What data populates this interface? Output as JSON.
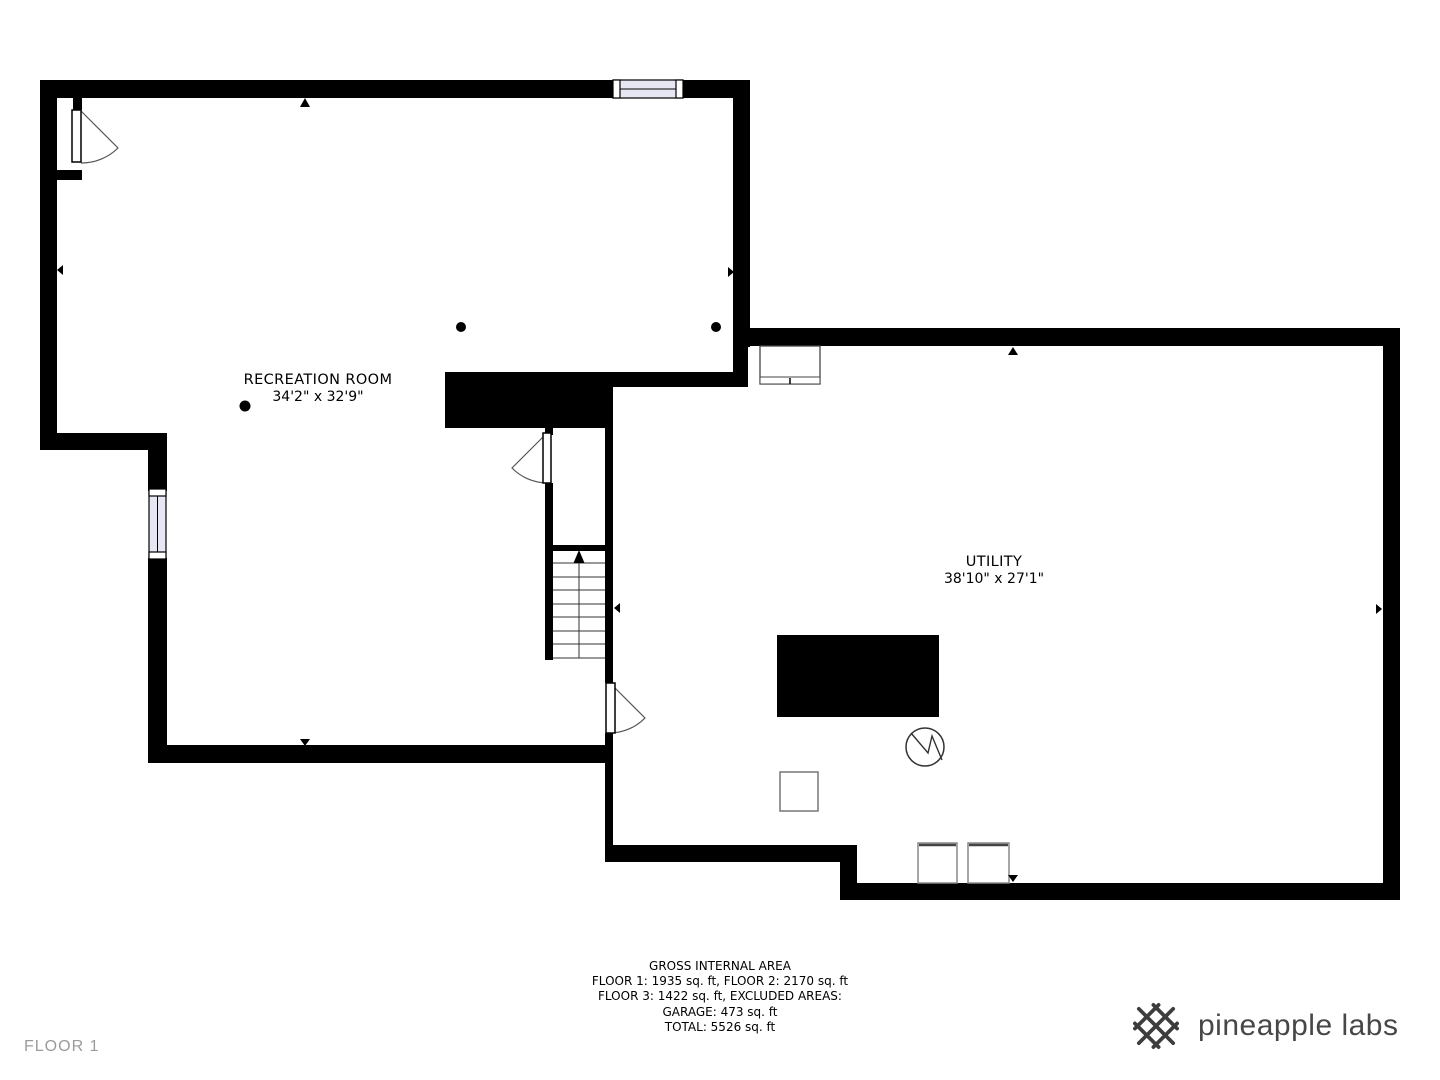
{
  "floor": {
    "label": "FLOOR 1"
  },
  "rooms": [
    {
      "name": "RECREATION ROOM",
      "dimensions": "34'2\" x 32'9\""
    },
    {
      "name": "UTILITY",
      "dimensions": "38'10\" x 27'1\""
    }
  ],
  "area_summary": {
    "title": "GROSS INTERNAL AREA",
    "line2": "FLOOR 1: 1935 sq. ft, FLOOR 2: 2170 sq. ft",
    "line3": "FLOOR 3: 1422 sq. ft, EXCLUDED AREAS:",
    "line4": "GARAGE: 473 sq. ft",
    "line5": "TOTAL: 5526 sq. ft"
  },
  "branding": {
    "name": "pineapple labs",
    "icon": "pineapple-lattice-icon"
  },
  "colors": {
    "wall": "#000000",
    "window_fill": "#e7e7f3",
    "floor_label_gray": "#9b9b9b",
    "logo_gray": "#474747"
  }
}
